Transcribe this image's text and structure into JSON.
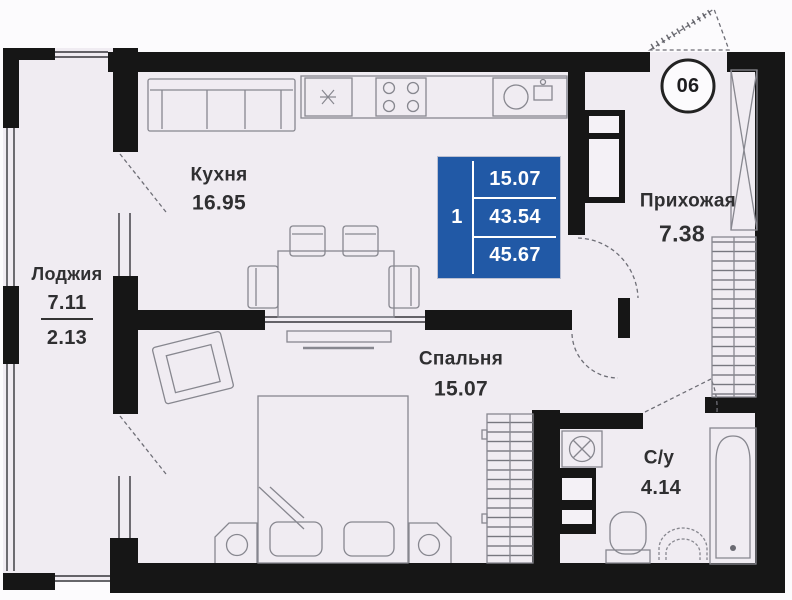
{
  "floor_plan": {
    "unit_badge": "06",
    "summary_table": {
      "rooms_count": "1",
      "living_area": "15.07",
      "area_without_loggia": "43.54",
      "total_area": "45.67"
    },
    "rooms": {
      "kitchen": {
        "name": "Кухня",
        "area": "16.95"
      },
      "loggia": {
        "name": "Лоджия",
        "area_full": "7.11",
        "area_reduced": "2.13"
      },
      "bedroom": {
        "name": "Спальня",
        "area": "15.07"
      },
      "hallway": {
        "name": "Прихожая",
        "area": "7.38"
      },
      "bathroom": {
        "name": "С/у",
        "area": "4.14"
      }
    },
    "colors": {
      "wall": "#161616",
      "floor": "#f0ecf2",
      "accent_blue": "#2159a6",
      "furniture_outline": "#87878f",
      "text": "#2f2f31"
    }
  }
}
